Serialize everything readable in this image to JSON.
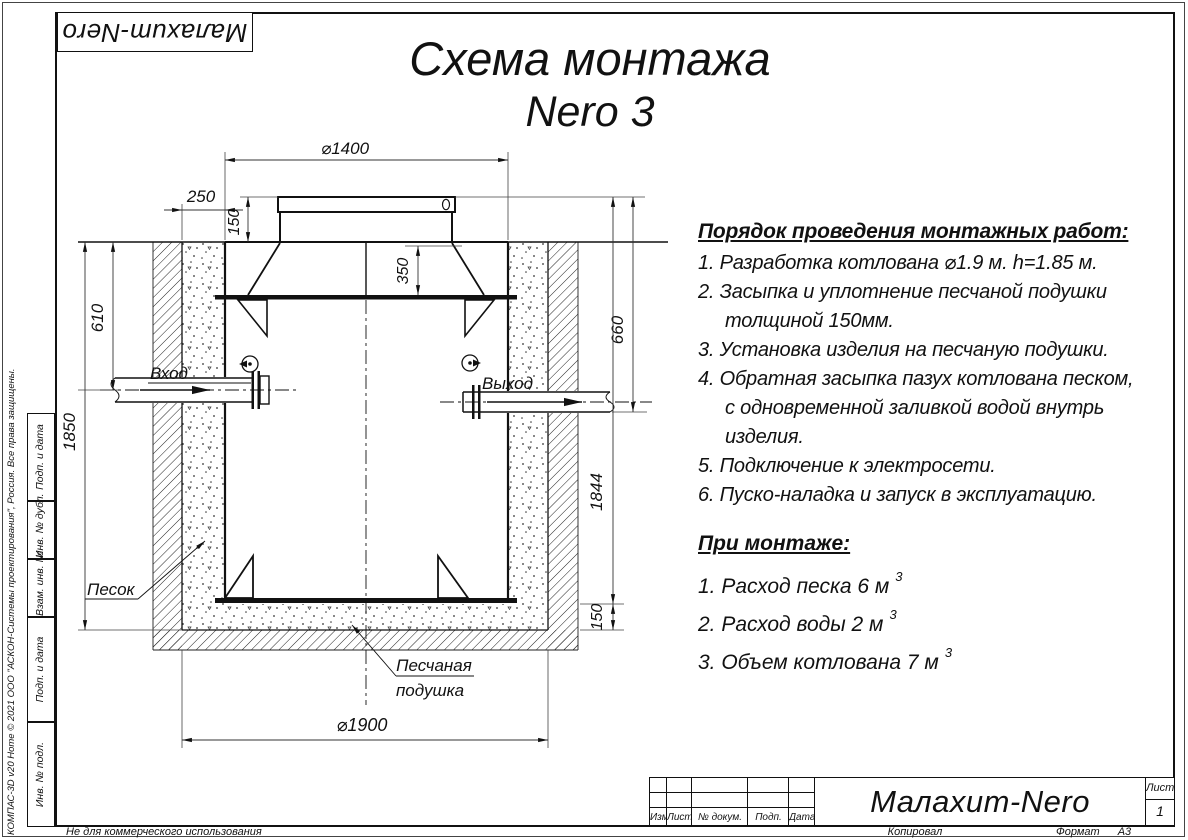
{
  "frame": {
    "logo_text": "Малахит-Nero",
    "compas_credit": "КОМПАС-3D v20 Home © 2021 ООО \"АСКОН-Системы проектирования\", Россия. Все права защищены.",
    "not_for_commercial": "Не для коммерческого использования",
    "stamp_cells": [
      "Подп. и дата",
      "Инв. № дубл.",
      "Взам. инв. №",
      "Подп. и дата",
      "Инв. № подл."
    ]
  },
  "title": {
    "line1": "Схема монтажа",
    "line2": "Nero 3"
  },
  "instructions": {
    "heading": "Порядок проведения монтажных работ:",
    "lines": [
      "1. Разработка котлована ⌀1.9 м. h=1.85 м.",
      "2. Засыпка и уплотнение песчаной подушки",
      "толщиной 150мм.",
      "3. Установка изделия на песчаную подушки.",
      "4. Обратная засыпка пазух котлована песком,",
      "с одновременной заливкой водой внутрь",
      "изделия.",
      "5. Подключение к электросети.",
      "6. Пуско-наладка и запуск в эксплуатацию."
    ]
  },
  "montage": {
    "heading": "При монтаже:",
    "items": [
      {
        "text": "1. Расход песка 6 м",
        "sup": "3"
      },
      {
        "text": "2. Расход воды 2 м",
        "sup": "3"
      },
      {
        "text": "3. Объем котлована 7 м",
        "sup": "3"
      }
    ]
  },
  "drawing": {
    "dimensions": {
      "lid_diameter": "⌀1400",
      "edge_offset": "250",
      "lid_height": "150",
      "shoulder_depth": "350",
      "inlet_depth": "610",
      "pit_depth": "1850",
      "outlet_depth": "660",
      "tank_height": "1844",
      "cushion_thickness": "150",
      "pit_diameter": "⌀1900"
    },
    "labels": {
      "inlet": "Вход",
      "outlet": "Выход",
      "sand": "Песок",
      "cushion_line1": "Песчаная",
      "cushion_line2": "подушка"
    }
  },
  "title_block": {
    "columns": [
      "Изм.",
      "Лист",
      "№ докум.",
      "Подп.",
      "Дата"
    ],
    "product": "Малахит-Nero",
    "sheet_label": "Лист",
    "sheet_number": "1",
    "copied_by": "Копировал",
    "format_label": "Формат",
    "format_value": "А3"
  }
}
